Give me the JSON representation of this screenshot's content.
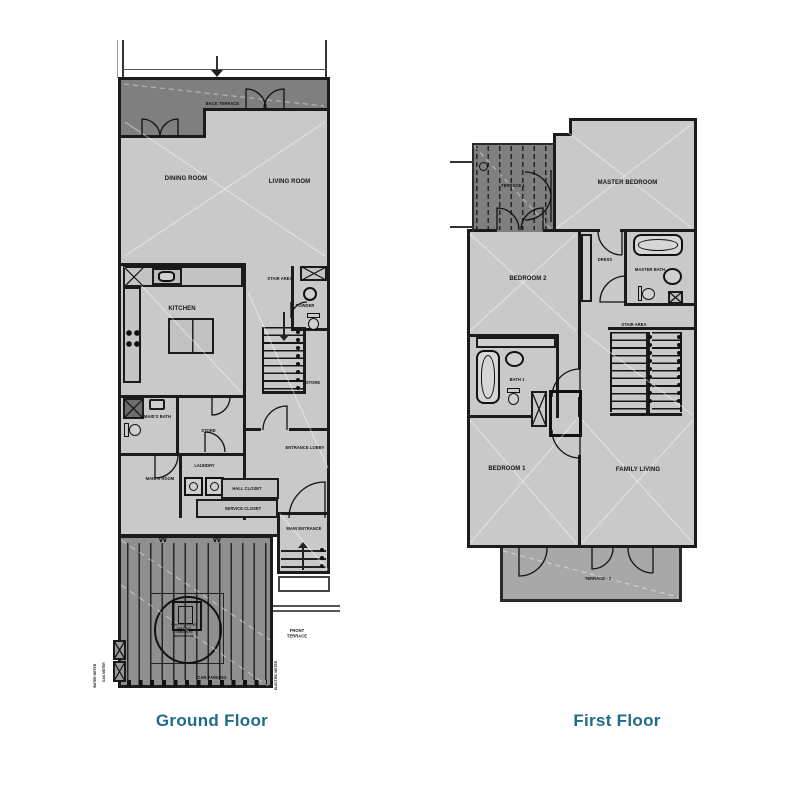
{
  "titles": {
    "ground": "Ground Floor",
    "first": "First Floor"
  },
  "colors": {
    "title_text": "#1f6b8a",
    "room_fill": "#c9c9c9",
    "terrace_dark": "#7f7f7f",
    "terrace_mid": "#a8a8a8",
    "parking_fill": "#8f8f8f",
    "wall": "#1b1b1b"
  },
  "ground_floor": {
    "labels": {
      "back_terrace": "BACK TERRACE",
      "dining_room": "DINING ROOM",
      "living_room": "LIVING ROOM",
      "kitchen": "KITCHEN",
      "stair_area": "STAIR AREA",
      "powder": "POWDER",
      "store_upper": "STORE",
      "maids_bath": "MAID'S BATH",
      "store_lower": "STORE",
      "laundry": "LAUNDRY",
      "maids_room": "MAID'S ROOM",
      "hall_closet": "HALL CLOSET",
      "service_closet": "SERVICE CLOSET",
      "entrance_lobby": "ENTRANCE LOBBY",
      "main_entrance": "MAIN ENTRANCE",
      "front_terrace": "FRONT TERRACE",
      "car_parking": "CAR PARKING",
      "water_tank": "UNDER GROUND PRECAST CONCRETE WATER TANK",
      "water_meter": "WATER METER",
      "gas_meter": "GAS METER",
      "electric_meter": "ELECTRIC METER"
    }
  },
  "first_floor": {
    "labels": {
      "terrace_1": "TERRACE 1",
      "master_bedroom": "MASTER BEDROOM",
      "bedroom_2": "BEDROOM 2",
      "dress": "DRESS",
      "master_bath": "MASTER BATH",
      "stair_area": "STAIR AREA",
      "bath_1": "BATH 1",
      "bedroom_1": "BEDROOM 1",
      "family_living": "FAMILY LIVING",
      "terrace_2": "TERRACE - 2"
    }
  }
}
